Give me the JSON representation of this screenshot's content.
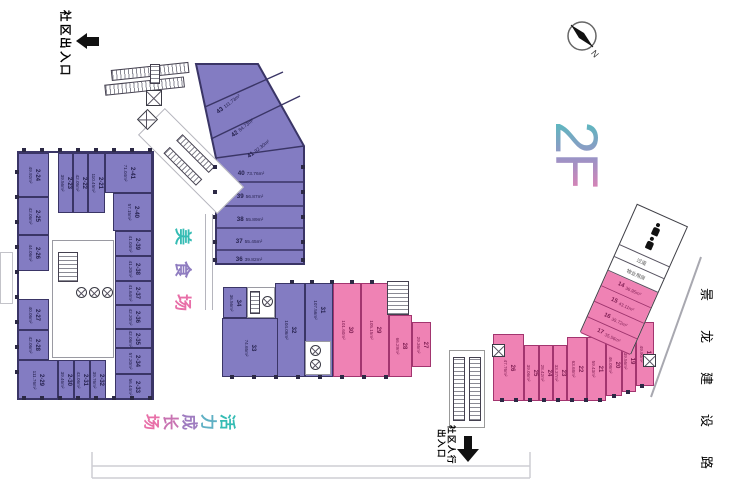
{
  "title": "2F",
  "compass_label": "N",
  "road_label": "景龙建设路",
  "entrance_top": "社区出入口",
  "entrance_bottom_line1": "社区人行",
  "entrance_bottom_line2": "出入口",
  "zone_food": "美食场",
  "zone_growth": "活力成长场",
  "room_corridor": "过道",
  "room_property": "物业用房",
  "colors": {
    "unit_purple": "#837cc2",
    "unit_pink": "#ef82b4",
    "teal_accent": "#35bcb4",
    "pink_accent": "#e86fa8",
    "wall": "#3a3566"
  },
  "units": {
    "2-21": {
      "no": "2-21",
      "area": "110.45m²",
      "group": "purple"
    },
    "2-22": {
      "no": "2-22",
      "area": "42.05m²",
      "group": "purple"
    },
    "2-23": {
      "no": "2-23",
      "area": "39.56m²",
      "group": "purple"
    },
    "2-24": {
      "no": "2-24",
      "area": "49.92m²",
      "group": "purple"
    },
    "2-25": {
      "no": "2-25",
      "area": "42.06m²",
      "group": "purple"
    },
    "2-26": {
      "no": "2-26",
      "area": "44.06m²",
      "group": "purple"
    },
    "2-27": {
      "no": "2-27",
      "area": "40.06m²",
      "group": "purple"
    },
    "2-28": {
      "no": "2-28",
      "area": "42.06m²",
      "group": "purple"
    },
    "2-29": {
      "no": "2-29",
      "area": "111.76m²",
      "group": "purple"
    },
    "2-30": {
      "no": "2-30",
      "area": "39.46m²",
      "group": "purple"
    },
    "2-31": {
      "no": "2-31",
      "area": "43.06m²",
      "group": "purple"
    },
    "2-32": {
      "no": "2-32",
      "area": "39.76m²",
      "group": "purple"
    },
    "2-33": {
      "no": "2-33",
      "area": "56.44m²",
      "group": "purple"
    },
    "2-34": {
      "no": "2-34",
      "area": "57.20m²",
      "group": "purple"
    },
    "2-35": {
      "no": "2-35",
      "area": "42.06m²",
      "group": "purple"
    },
    "2-36": {
      "no": "2-36",
      "area": "42.20m²",
      "group": "purple"
    },
    "2-37": {
      "no": "2-37",
      "area": "41.64m²",
      "group": "purple"
    },
    "2-38": {
      "no": "2-38",
      "area": "41.20m²",
      "group": "purple"
    },
    "2-39": {
      "no": "2-39",
      "area": "41.04m²",
      "group": "purple"
    },
    "2-40": {
      "no": "2-40",
      "area": "57.15m²",
      "group": "purple"
    },
    "2-41": {
      "no": "2-41",
      "area": "71.04m²",
      "group": "purple"
    },
    "36": {
      "no": "36",
      "area": "39.82m²",
      "group": "purple"
    },
    "37": {
      "no": "37",
      "area": "55.45m²",
      "group": "purple"
    },
    "38": {
      "no": "38",
      "area": "55.89m²",
      "group": "purple"
    },
    "39": {
      "no": "39",
      "area": "56.87m²",
      "group": "purple"
    },
    "40": {
      "no": "40",
      "area": "73.76m²",
      "group": "purple"
    },
    "41": {
      "no": "41",
      "area": "92.30m²",
      "group": "purple"
    },
    "42": {
      "no": "42",
      "area": "84.73m²",
      "group": "purple"
    },
    "43": {
      "no": "43",
      "area": "111.73m²",
      "group": "purple"
    },
    "31": {
      "no": "31",
      "area": "107.56m²",
      "group": "purple"
    },
    "32": {
      "no": "32",
      "area": "104.06m²",
      "group": "purple"
    },
    "33": {
      "no": "33",
      "area": "74.65m²",
      "group": "purple"
    },
    "34": {
      "no": "34",
      "area": "36.56m²",
      "group": "purple"
    },
    "27": {
      "no": "27",
      "area": "29.36m²",
      "group": "pink"
    },
    "28": {
      "no": "28",
      "area": "66.29m²",
      "group": "pink"
    },
    "29": {
      "no": "29",
      "area": "105.15m²",
      "group": "pink"
    },
    "30": {
      "no": "30",
      "area": "101.60m²",
      "group": "pink"
    },
    "14": {
      "no": "14",
      "area": "36.95m²",
      "group": "pink"
    },
    "15": {
      "no": "15",
      "area": "43.11m²",
      "group": "pink"
    },
    "16": {
      "no": "16",
      "area": "35.72m²",
      "group": "pink"
    },
    "17": {
      "no": "17",
      "area": "35.56m²",
      "group": "pink"
    },
    "18": {
      "no": "18",
      "area": "49.90m²",
      "group": "pink"
    },
    "19": {
      "no": "19",
      "area": "39.56m²",
      "group": "pink"
    },
    "20": {
      "no": "20",
      "area": "46.08m²",
      "group": "pink"
    },
    "21": {
      "no": "21",
      "area": "59.43m²",
      "group": "pink"
    },
    "22": {
      "no": "22",
      "area": "63.68m²",
      "group": "pink"
    },
    "23": {
      "no": "23",
      "area": "33.37m²",
      "group": "pink"
    },
    "24": {
      "no": "24",
      "area": "28.42m²",
      "group": "pink"
    },
    "25": {
      "no": "25",
      "area": "39.06m²",
      "group": "pink"
    },
    "26": {
      "no": "26",
      "area": "47.76m²",
      "group": "pink"
    }
  }
}
